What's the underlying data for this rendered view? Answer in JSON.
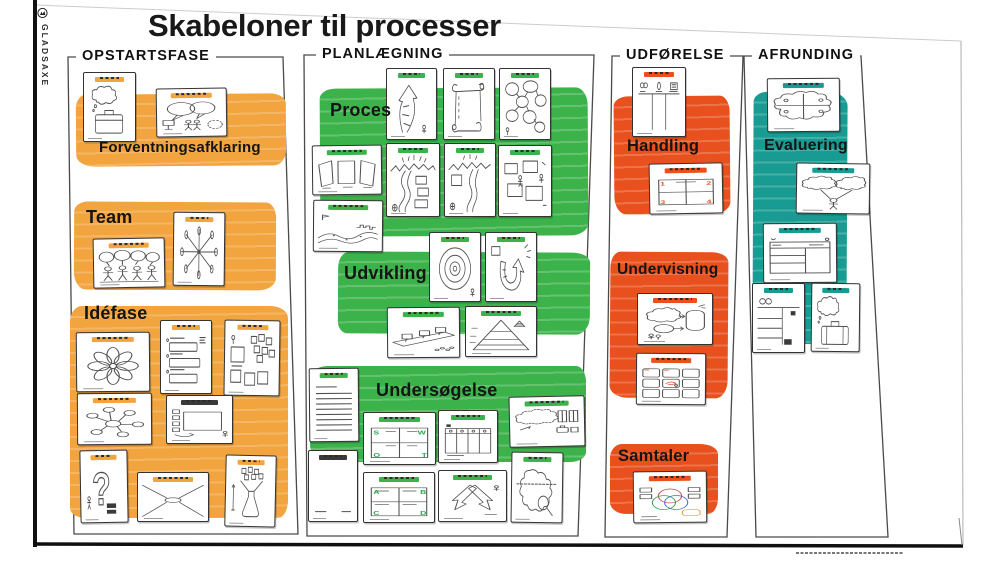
{
  "header": {
    "title": "Skabeloner til processer",
    "brand": "GLADSAXE"
  },
  "columns": [
    {
      "label": "OPSTARTSFASE",
      "color": "#F2A43E",
      "sections": [
        {
          "label": "Forventningsafklaring",
          "cards": [
            "thought-suitcase",
            "speech-bubbles-people"
          ]
        },
        {
          "label": "Team",
          "cards": [
            "people-speech-bubbles",
            "radial-spokes"
          ]
        },
        {
          "label": "Idéfase",
          "cards": [
            "flower-petals",
            "numbered-form",
            "sticky-notes",
            "mind-map",
            "board-with-notes",
            "question-mark",
            "perspective-lines",
            "funnel-flask"
          ]
        }
      ]
    },
    {
      "label": "PLANLÆGNING",
      "color": "#3CB24B",
      "sections": [
        {
          "label": "Proces",
          "cards": [
            "curved-arrow",
            "scroll",
            "cloud-chain",
            "three-panels",
            "river-with-boxes",
            "river-path",
            "boxes-figures",
            "landscape-path"
          ]
        },
        {
          "label": "Udvikling",
          "cards": [
            "concentric-circles",
            "u-arrow",
            "shelf-boxes",
            "pyramid"
          ]
        },
        {
          "label": "Undersøgelse",
          "cards": [
            "lined-page",
            "swot-grid",
            "column-table",
            "cloud-with-notes",
            "blank-page",
            "abcd-grid",
            "arrow-shapes",
            "iceberg-magnifier"
          ]
        }
      ]
    },
    {
      "label": "UDFØRELSE",
      "color": "#E8511D",
      "sections": [
        {
          "label": "Handling",
          "cards": [
            "three-columns",
            "numbered-quadrants"
          ]
        },
        {
          "label": "Undervisning",
          "cards": [
            "clouds-flow",
            "nine-grid-storyboard"
          ]
        },
        {
          "label": "Samtaler",
          "cards": [
            "venn-diagram"
          ]
        }
      ]
    },
    {
      "label": "AFRUNDING",
      "color": "#189B92",
      "sections": [
        {
          "label": "Evaluering",
          "cards": [
            "cloud-quadrant",
            "two-clouds-person",
            "split-table",
            "two-column-list",
            "suitcase-thought"
          ]
        }
      ]
    }
  ],
  "card_marks": {
    "swot": [
      "S",
      "W",
      "O",
      "T"
    ],
    "abcd": [
      "A",
      "B",
      "C",
      "D"
    ],
    "quadrants": [
      "1",
      "2",
      "3",
      "4"
    ],
    "question": "?"
  }
}
